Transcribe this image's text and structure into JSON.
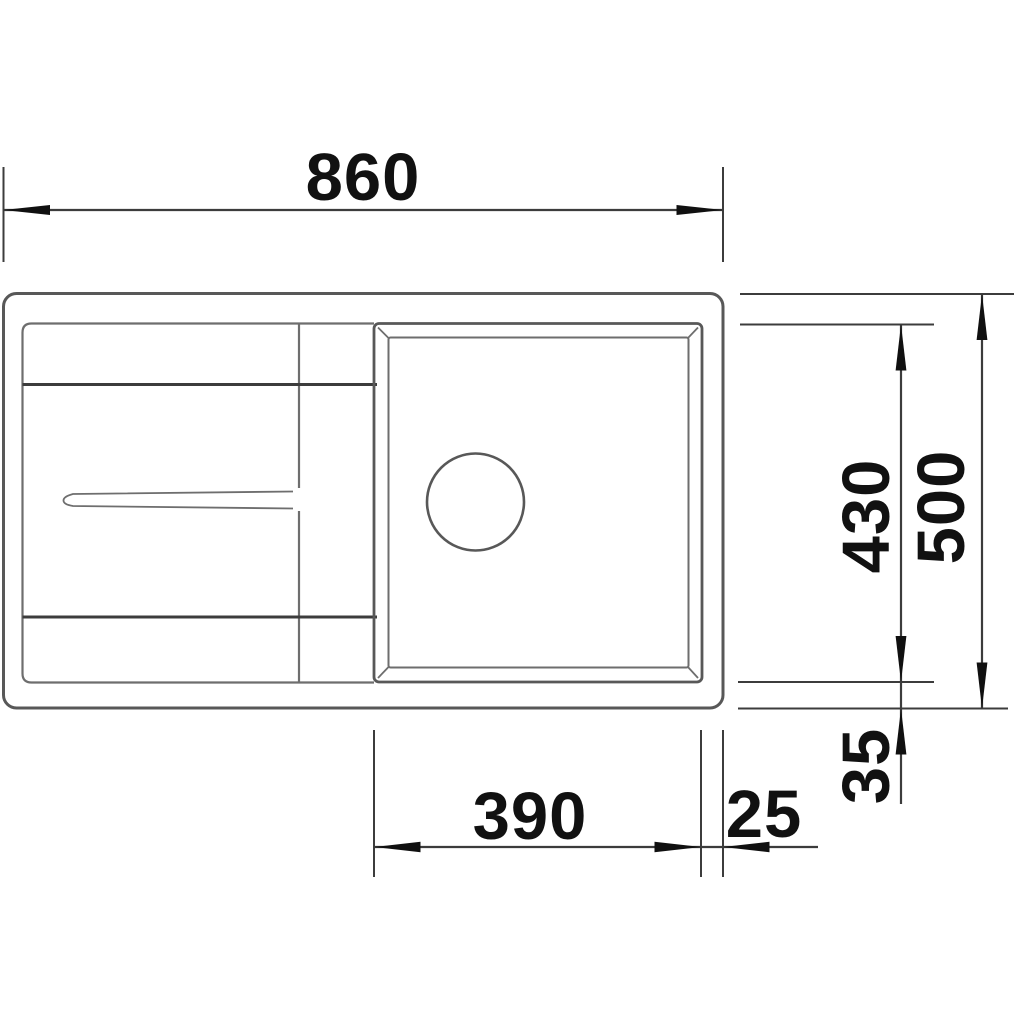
{
  "drawing": {
    "subject": "Kitchen sink with drainboard and single bowl - top view dimension drawing",
    "style": "monochrome technical line drawing on white background",
    "features": [
      "outer-sink-outline",
      "drainboard-with-drain-channel",
      "bowl-with-rim",
      "drain-hole"
    ]
  },
  "dimensions": {
    "overall_width": "860",
    "overall_depth": "500",
    "bowl_depth": "430",
    "bowl_width": "390",
    "bowl_right_offset": "25",
    "bowl_bottom_offset": "35"
  },
  "colors": {
    "background": "#ffffff",
    "outline_gray": "#585858",
    "outline_light": "#6e6e6e",
    "accent_dark": "#3c3c3c",
    "arrow_black": "#101010",
    "text_black": "#111111"
  }
}
